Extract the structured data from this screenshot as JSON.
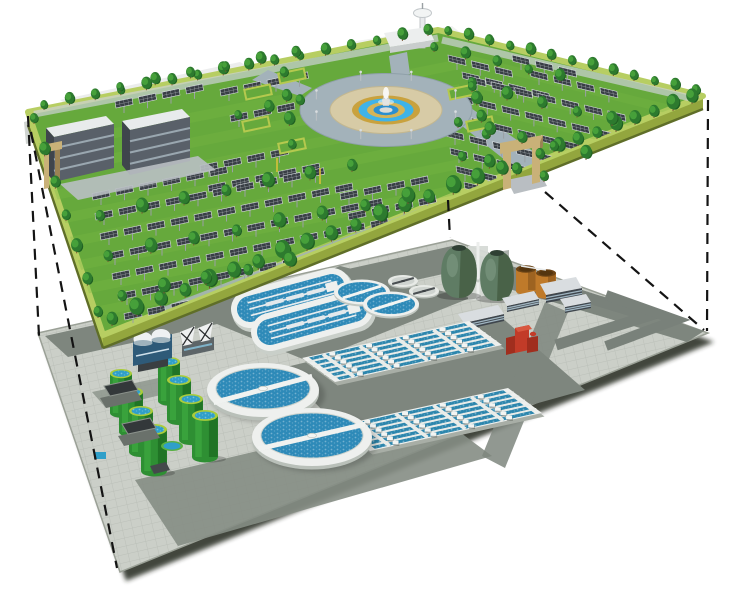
{
  "title": "Cutaway illustration: solar park ground level above an underground wastewater treatment plant",
  "background": "#ffffff",
  "palette": {
    "grass": "#66a93c",
    "grass_light": "#7ab845",
    "deck_border": "#b7ce62",
    "deck_side": "#a9bc4a",
    "deck_side_dark": "#5f6e28",
    "tree": "#2d7a2e",
    "tree_shade": "#1f5f22",
    "tree_light": "#46a03a",
    "panel": "#383e45",
    "panel_frame": "#d7dce0",
    "pole": "#9aa0a4",
    "road": "#a3b2ba",
    "plaza": "#d7cba6",
    "gold": "#c9a23e",
    "gold_light": "#d4b458",
    "fountain_blue": "#3fb3e8",
    "fountain_blue_deep": "#2b8fd0",
    "building_wall": "#596069",
    "building_end": "#3f454c",
    "building_roof": "#e8ebec",
    "building_window": "#9aa7b0",
    "gate_tan": "#c9b178",
    "gate_tan_dark": "#9a8354",
    "pad": "#cbcfc8",
    "pad_road": "#7e867e",
    "pad_road_dark": "#70786f",
    "white_struct": "#eef0ee",
    "struct_shadow": "#b9beb9",
    "water": "#2e8ab8",
    "basin_water": "#2c86ad",
    "tank_green": "#2e8f33",
    "tank_green_dark": "#1c6b22",
    "tank_rim": "#a9cc3b",
    "tank_water": "#2f9fc9",
    "egg": "#5f7c64",
    "egg_dark": "#42593f",
    "egg_cap": "#2f4034",
    "rust": "#bf7a2a",
    "rust_dark": "#8f5a1e",
    "red": "#c23b28",
    "red_dark": "#a02e1e",
    "dark_building": "#3f464d",
    "line": "#141414"
  },
  "upper_layer": {
    "label": "solar park ground level",
    "deck": {
      "corners": [
        [
          28,
          112
        ],
        [
          438,
          30
        ],
        [
          703,
          96
        ],
        [
          103,
          335
        ]
      ],
      "thickness": 13
    },
    "fountain_plaza": {
      "center": [
        386,
        110
      ],
      "ring_road_rx": 86,
      "ring_road_ry": 36.5,
      "plaza_rx": 56,
      "plaza_ry": 23.5
    },
    "buildings": 2,
    "gates": 2,
    "observation_tower": 1,
    "panel_rows_left": [
      [
        115,
        98,
        4
      ],
      [
        220,
        86,
        4
      ],
      [
        230,
        112,
        3
      ],
      [
        200,
        162,
        4
      ],
      [
        208,
        182,
        5
      ],
      [
        92,
        190,
        6
      ],
      [
        95,
        210,
        10
      ],
      [
        100,
        230,
        11
      ],
      [
        106,
        250,
        12
      ],
      [
        112,
        270,
        12
      ],
      [
        118,
        290,
        8
      ],
      [
        124,
        310,
        4
      ],
      [
        340,
        190,
        4
      ],
      [
        348,
        210,
        4
      ]
    ],
    "panel_rows_right": [
      [
        448,
        55,
        3
      ],
      [
        462,
        72,
        4
      ],
      [
        512,
        55,
        3
      ],
      [
        530,
        70,
        4
      ],
      [
        468,
        76,
        7
      ],
      [
        455,
        94,
        7
      ],
      [
        448,
        112,
        6
      ],
      [
        446,
        130,
        5
      ],
      [
        450,
        148,
        4
      ],
      [
        456,
        166,
        3
      ],
      [
        464,
        182,
        1
      ]
    ],
    "tree_lines": [
      [
        44,
        110,
        428,
        36,
        16,
        9
      ],
      [
        448,
        36,
        696,
        96,
        13,
        9
      ],
      [
        540,
        160,
        692,
        104,
        9,
        11
      ],
      [
        112,
        326,
        502,
        176,
        17,
        13
      ],
      [
        34,
        124,
        98,
        318,
        7,
        10
      ],
      [
        100,
        222,
        352,
        172,
        7,
        11
      ],
      [
        108,
        262,
        408,
        204,
        8,
        11
      ],
      [
        122,
        302,
        290,
        268,
        5,
        11
      ],
      [
        292,
        150,
        284,
        78,
        4,
        10
      ],
      [
        472,
        88,
        486,
        140,
        4,
        10
      ],
      [
        472,
        92,
        612,
        126,
        5,
        10
      ],
      [
        458,
        128,
        586,
        160,
        5,
        10
      ],
      [
        462,
        162,
        544,
        182,
        4,
        10
      ],
      [
        120,
        92,
        296,
        58,
        6,
        9
      ],
      [
        434,
        52,
        560,
        82,
        5,
        9
      ],
      [
        238,
        120,
        300,
        106,
        3,
        9
      ]
    ],
    "lamp_angles": [
      20,
      70,
      110,
      160,
      200,
      250,
      290,
      340
    ]
  },
  "lower_layer": {
    "label": "underground wastewater treatment plant",
    "pad": {
      "corners": [
        [
          38,
          333
        ],
        [
          452,
          240
        ],
        [
          708,
          333
        ],
        [
          120,
          572
        ]
      ]
    },
    "equipment": {
      "egg_digesters": 2,
      "green_storage_tanks": 8,
      "clarifiers_large": 2,
      "clarifiers_medium": 2,
      "clarifiers_small": 2,
      "aeration_basins": 2,
      "basin_lanes": 6,
      "oxidation_ditches": 2,
      "rust_tanks": 2,
      "service_buildings": 4,
      "red_pump_unit": 1
    },
    "green_tanks": [
      [
        121,
        369,
        11,
        44
      ],
      [
        169,
        357,
        11,
        44
      ],
      [
        131,
        387,
        12,
        45
      ],
      [
        179,
        375,
        12,
        45
      ],
      [
        141,
        406,
        12,
        46
      ],
      [
        191,
        394,
        12,
        46
      ],
      [
        154,
        424,
        13,
        47
      ],
      [
        205,
        410,
        13,
        47
      ]
    ]
  },
  "projection_lines": {
    "count": 5,
    "dash": "11 8",
    "width": 2.2,
    "segments": [
      [
        28,
        116,
        39,
        336
      ],
      [
        31,
        132,
        117,
        568
      ],
      [
        708,
        100,
        707,
        331
      ],
      [
        545,
        192,
        704,
        330
      ],
      [
        448,
        200,
        450,
        238
      ]
    ]
  }
}
